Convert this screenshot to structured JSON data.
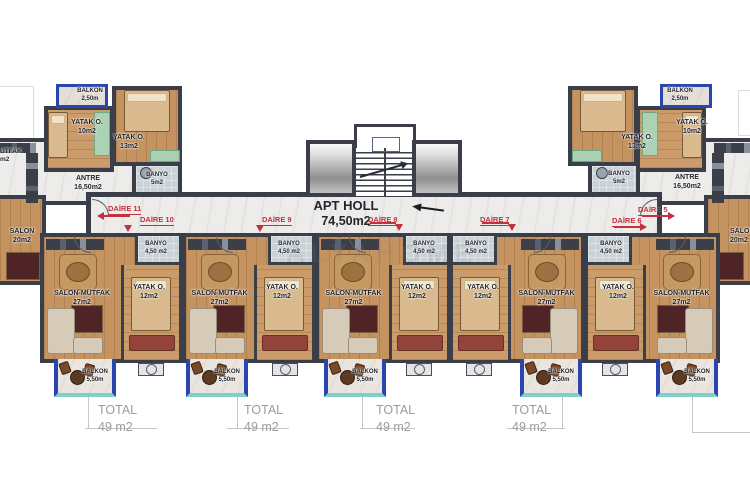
{
  "watermark": "ALYAHOME",
  "hall": {
    "name": "APT HOLL",
    "area": "74,50m2"
  },
  "wings": {
    "left": {
      "daire": "DAİRE 11",
      "balkon": {
        "name": "BALKON",
        "area": "2,50m"
      },
      "yatak_small": {
        "name": "YATAK O.",
        "area": "10m2"
      },
      "yatak_big": {
        "name": "YATAK O.",
        "area": "13m2"
      },
      "banyo": {
        "name": "BANYO",
        "area": "5m2"
      },
      "antre": {
        "name": "ANTRE",
        "area": "16,50m2"
      },
      "mutfak_clipped": {
        "name": "UTFAK",
        "area": "m2"
      },
      "salon": {
        "name": "SALON",
        "area": "20m2"
      }
    },
    "right": {
      "daire": "DAİRE 5",
      "balkon": {
        "name": "BALKON",
        "area": "2,50m"
      },
      "yatak_small": {
        "name": "YATAK O.",
        "area": "10m2"
      },
      "yatak_big": {
        "name": "YATAK O.",
        "area": "13m2"
      },
      "banyo": {
        "name": "BANYO",
        "area": "5m2"
      },
      "antre": {
        "name": "ANTRE",
        "area": "16,50m2"
      },
      "salon": {
        "name": "SALON",
        "area": "20m2"
      }
    }
  },
  "units": [
    {
      "daire": "DAİRE 10",
      "x": 40,
      "w": 142,
      "mirrored": false,
      "balcony_x": 54,
      "ac_x": 138,
      "salon": {
        "name": "SALON-MUTFAK",
        "area": "27m2"
      },
      "yatak": {
        "name": "YATAK O.",
        "area": "12m2"
      },
      "banyo": {
        "name": "BANYO",
        "area": "4,50 m2"
      },
      "balkon": {
        "name": "BALKON",
        "area": "5,50m"
      }
    },
    {
      "daire": "DAİRE 9",
      "x": 182,
      "w": 133,
      "mirrored": false,
      "balcony_x": 186,
      "ac_x": 272,
      "salon": {
        "name": "SALON-MUTFAK",
        "area": "27m2"
      },
      "yatak": {
        "name": "YATAK O.",
        "area": "12m2"
      },
      "banyo": {
        "name": "BANYO",
        "area": "4,50 m2"
      },
      "balkon": {
        "name": "BALKON",
        "area": "5,50m"
      }
    },
    {
      "daire": "DAİRE 8",
      "x": 315,
      "w": 135,
      "mirrored": false,
      "balcony_x": 324,
      "ac_x": 406,
      "salon": {
        "name": "SALON-MUTFAK",
        "area": "27m2"
      },
      "yatak": {
        "name": "YATAK O.",
        "area": "12m2"
      },
      "banyo": {
        "name": "BANYO",
        "area": "4,50 m2"
      },
      "balkon": {
        "name": "BALKON",
        "area": "5,50m"
      }
    },
    {
      "daire": "DAİRE 7",
      "x": 450,
      "w": 135,
      "mirrored": true,
      "balcony_x": 520,
      "ac_x": 466,
      "salon": {
        "name": "SALON-MUTFAK",
        "area": "27m2"
      },
      "yatak": {
        "name": "YATAK O.",
        "area": "12m2"
      },
      "banyo": {
        "name": "BANYO",
        "area": "4,50 m2"
      },
      "balkon": {
        "name": "BALKON",
        "area": "5,50m"
      }
    },
    {
      "daire": "DAİRE 6",
      "x": 585,
      "w": 135,
      "mirrored": true,
      "balcony_x": 656,
      "ac_x": 602,
      "salon": {
        "name": "SALON-MUTFAK",
        "area": "27m2"
      },
      "yatak": {
        "name": "YATAK O.",
        "area": "12m2"
      },
      "banyo": {
        "name": "BANYO",
        "area": "4,50 m2"
      },
      "balkon": {
        "name": "BALKON",
        "area": "5,50m"
      }
    }
  ],
  "daire_labels": [
    {
      "label": "DAİRE 11",
      "x": 108,
      "y": 204,
      "dir": "left",
      "ax": 97,
      "ay": 212,
      "line": {
        "x": 104,
        "y": 215,
        "w": 26
      }
    },
    {
      "label": "DAİRE 10",
      "x": 140,
      "y": 215,
      "dir": "down",
      "ax": 124,
      "ay": 225
    },
    {
      "label": "DAİRE 9",
      "x": 262,
      "y": 215,
      "dir": "down",
      "ax": 256,
      "ay": 225
    },
    {
      "label": "DAİRE 8",
      "x": 368,
      "y": 215,
      "dir": "down",
      "ax": 395,
      "ay": 224,
      "line": {
        "x": 370,
        "y": 222,
        "w": 26
      }
    },
    {
      "label": "DAİRE 7",
      "x": 480,
      "y": 215,
      "dir": "down",
      "ax": 508,
      "ay": 224,
      "line": {
        "x": 482,
        "y": 222,
        "w": 27
      }
    },
    {
      "label": "DAİRE 6",
      "x": 612,
      "y": 216,
      "dir": "right",
      "ax": 640,
      "ay": 223,
      "line": {
        "x": 614,
        "y": 226,
        "w": 26
      }
    },
    {
      "label": "DAİRE 5",
      "x": 638,
      "y": 205,
      "dir": "right",
      "ax": 668,
      "ay": 212,
      "line": {
        "x": 642,
        "y": 215,
        "w": 26
      }
    }
  ],
  "totals": [
    {
      "label": "TOTAL",
      "area": "49 m2",
      "text_x": 98,
      "vline_x": 88,
      "hline_x": 85,
      "hline_w": 72
    },
    {
      "label": "TOTAL",
      "area": "49 m2",
      "text_x": 244,
      "vline_x": 237,
      "hline_x": 227,
      "hline_w": 62
    },
    {
      "label": "TOTAL",
      "area": "49 m2",
      "text_x": 376,
      "vline_x": 362,
      "hline_x": 360,
      "hline_w": 55
    },
    {
      "label": "TOTAL",
      "area": "49 m2",
      "text_x": 512,
      "vline_x": 562,
      "hline_x": 507,
      "hline_w": 58
    }
  ],
  "colors": {
    "wall": "#3a3e48",
    "accent_red": "#c2323e",
    "balcony_blue": "#2a46ae",
    "balcony_teal": "#7fd0cc",
    "wood": "#c4935f",
    "hall_floor": "#edecea",
    "tile": "#c9d2d6",
    "total_gray": "#9c9c9c"
  }
}
